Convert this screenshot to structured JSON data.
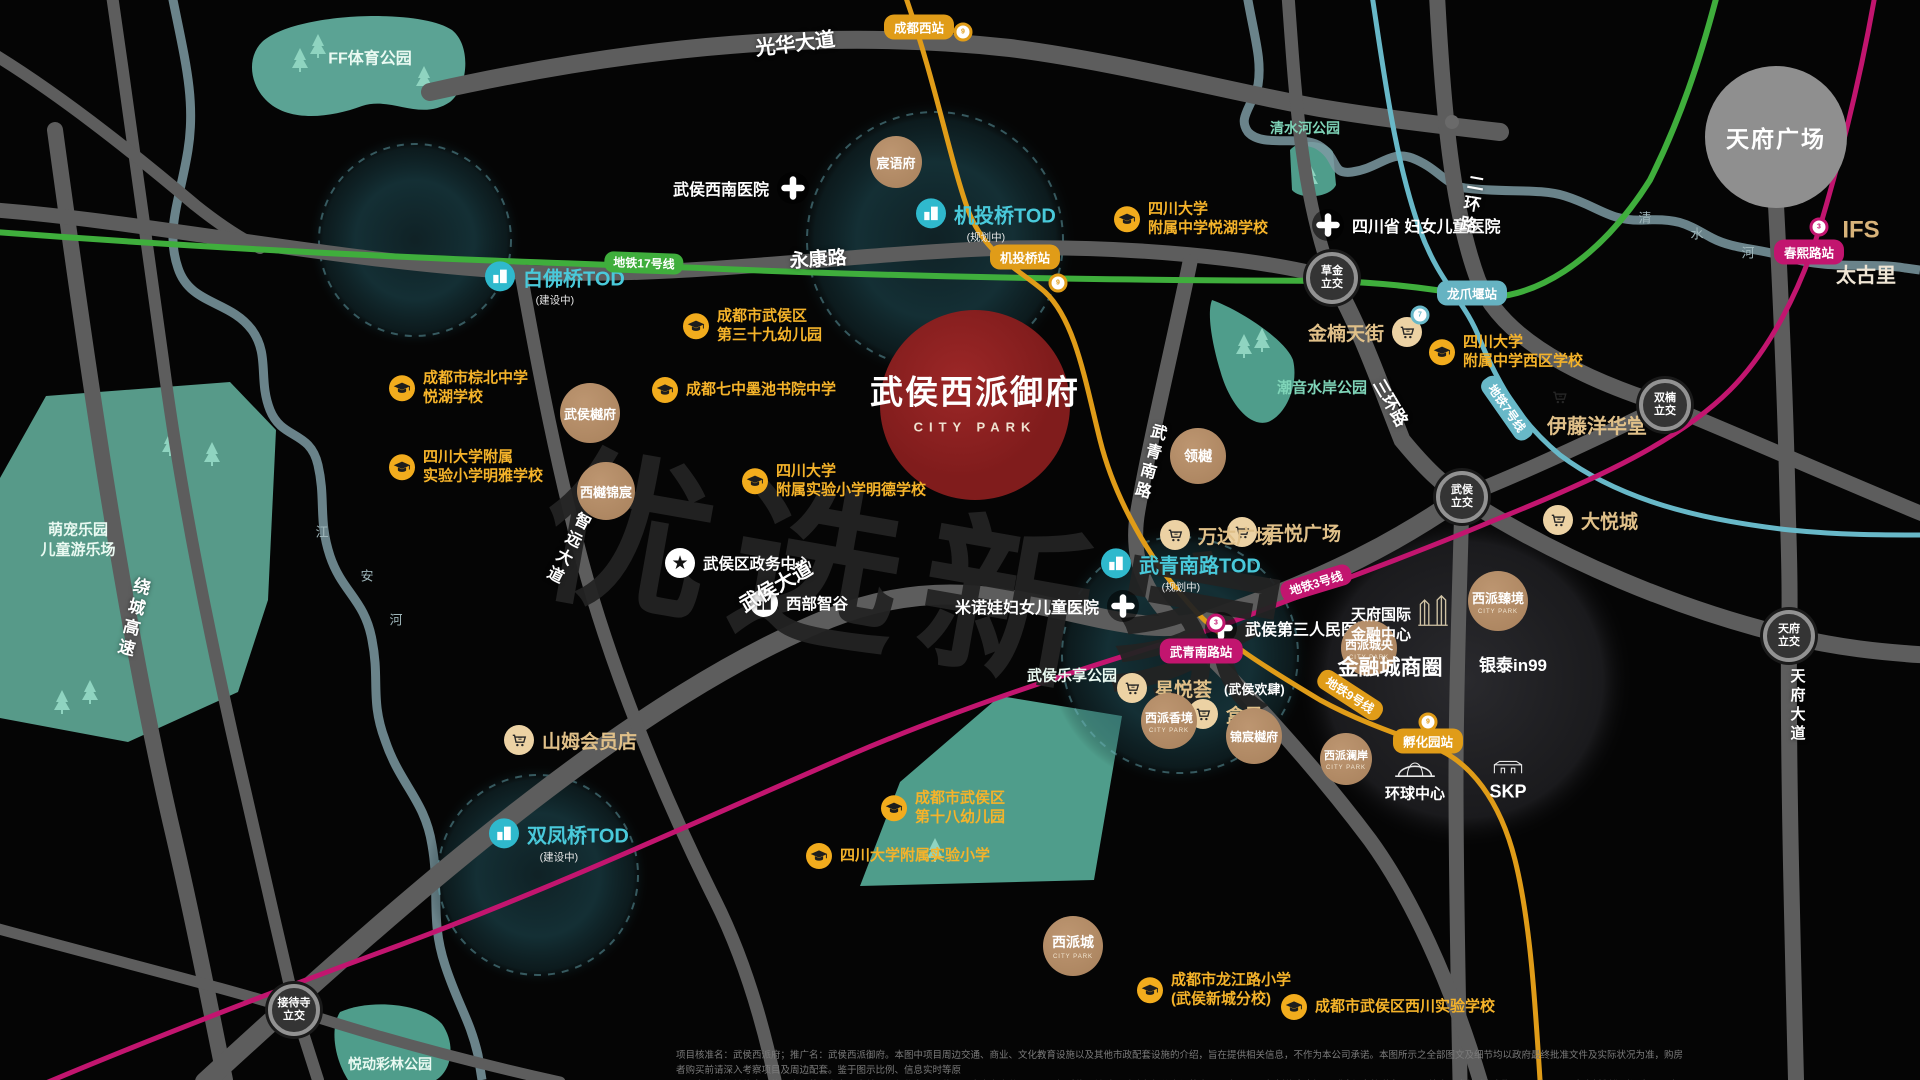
{
  "meta": {
    "title": "武侯西派御府 CITY PARK 区位图",
    "watermark": "优选新家"
  },
  "disclaimer": {
    "line1": "项目核准名：武侯西派府；推广名：武侯西派御府。本图中项目周边交通、商业、文化教育设施以及其他市政配套设施的介绍，旨在提供相关信息，不作为本公司承诺。本图所示之全部图文及细节均以政府最终批准文件及实际状况为准，购房者购买前请深入考察项目及周边配套。鉴于图示比例、信息实时等原",
    "line2": "因，本图中相关信息可能与实际状况存在一定差异，仅作为项目位置示意之参考使用，图示相对位置关系不反映各部分之间的实际距离；TOD规划信息来源于《成都市轨道交通TOD综合开发战略规划》，2021年3月。本资料制作时间为2025年10月，本公司保留对本资料进行修改的权利，敬请留意最新资料。"
  },
  "colors": {
    "metro17": "#3fae3c",
    "metro9": "#e09c18",
    "metro3": "#c2156f",
    "metro7": "#68b8c8",
    "school": "#f5b32a",
    "tod": "#49c9da",
    "shop_text": "#e0c089",
    "project_red": "#8e2222"
  },
  "pois": [
    {
      "type": "tod",
      "name": "tod-baifoqiao",
      "x": 500,
      "y": 288,
      "label": "白佛桥TOD",
      "sub": "(建设中)"
    },
    {
      "type": "tod",
      "name": "tod-jitouqiao",
      "x": 931,
      "y": 225,
      "label": "机投桥TOD",
      "sub": "(规划中)"
    },
    {
      "type": "tod",
      "name": "tod-wuqingnanlu",
      "x": 1116,
      "y": 575,
      "label": "武青南路TOD",
      "sub": "(规划中)"
    },
    {
      "type": "tod",
      "name": "tod-shuangfengqiao",
      "x": 504,
      "y": 845,
      "label": "双凤桥TOD",
      "sub": "(建设中)"
    },
    {
      "type": "projtitle",
      "name": "project-title",
      "x": 975,
      "y": 400,
      "label": "武侯西派御府",
      "sub": "CITY PARK"
    },
    {
      "type": "school",
      "name": "school-39-kindergarten",
      "x": 696,
      "y": 326,
      "lines": [
        "成都市武侯区",
        "第三十九幼儿园"
      ]
    },
    {
      "type": "school",
      "name": "school-yuehu-middle",
      "x": 1127,
      "y": 219,
      "lines": [
        "四川大学",
        "附属中学悦湖学校"
      ]
    },
    {
      "type": "school",
      "name": "school-mochi-academy",
      "x": 665,
      "y": 390,
      "lines": [
        "成都七中墨池书院中学"
      ]
    },
    {
      "type": "school",
      "name": "school-mingde-primary",
      "x": 755,
      "y": 481,
      "lines": [
        "四川大学",
        "附属实验小学明德学校"
      ]
    },
    {
      "type": "school",
      "name": "school-zongbei-middle",
      "x": 402,
      "y": 388,
      "lines": [
        "成都市棕北中学",
        "悦湖学校"
      ]
    },
    {
      "type": "school",
      "name": "school-mingya-primary",
      "x": 402,
      "y": 467,
      "lines": [
        "四川大学附属",
        "实验小学明雅学校"
      ]
    },
    {
      "type": "school",
      "name": "school-xiqu-middle",
      "x": 1442,
      "y": 352,
      "lines": [
        "四川大学",
        "附属中学西区学校"
      ]
    },
    {
      "type": "school",
      "name": "school-18-kindergarten",
      "x": 894,
      "y": 808,
      "lines": [
        "成都市武侯区",
        "第十八幼儿园"
      ]
    },
    {
      "type": "school",
      "name": "school-scu-primary",
      "x": 819,
      "y": 856,
      "lines": [
        "四川大学附属实验小学"
      ]
    },
    {
      "type": "school",
      "name": "school-longjiang-primary",
      "x": 1150,
      "y": 990,
      "lines": [
        "成都市龙江路小学",
        "(武侯新城分校)"
      ]
    },
    {
      "type": "school",
      "name": "school-xichuan-experimental",
      "x": 1294,
      "y": 1007,
      "lines": [
        "成都市武侯区西川实验学校"
      ]
    },
    {
      "type": "hospital",
      "name": "hospital-wuhou-southwest",
      "x": 793,
      "y": 188,
      "label": "武侯西南医院",
      "side": "r"
    },
    {
      "type": "hospital",
      "name": "hospital-sichuan-women-children",
      "x": 1328,
      "y": 225,
      "label": "四川省 妇女儿童医院",
      "side": "l"
    },
    {
      "type": "hospital",
      "name": "hospital-minuowa",
      "x": 1123,
      "y": 606,
      "label": "米诺娃妇女儿童医院",
      "side": "r"
    },
    {
      "type": "hospital",
      "name": "hospital-wuhou-third",
      "x": 1221,
      "y": 628,
      "label": "武侯第三人民医院",
      "side": "l"
    },
    {
      "type": "gov",
      "name": "gov-wuhou-admin-center",
      "x": 680,
      "y": 563,
      "label": "武侯区政务中心"
    },
    {
      "type": "biz",
      "name": "biz-west-smart-valley",
      "x": 764,
      "y": 603,
      "label": "西部智谷"
    },
    {
      "type": "shop",
      "name": "shop-jinnan-tianjie",
      "x": 1407,
      "y": 332,
      "label": "金楠天街",
      "side": "r"
    },
    {
      "type": "glyph",
      "name": "cart-icon-yito",
      "x": 1560,
      "y": 400,
      "glyph": "cart"
    },
    {
      "type": "landmark",
      "name": "shop-yito-yokado",
      "x": 1597,
      "y": 427,
      "label": "伊藤洋华堂",
      "fs": 20,
      "col": "#e0c089"
    },
    {
      "type": "shop",
      "name": "shop-joy-city",
      "x": 1558,
      "y": 520,
      "label": "大悦城",
      "side": "l"
    },
    {
      "type": "shop",
      "name": "shop-wuyue-plaza",
      "x": 1242,
      "y": 532,
      "label": "吾悦广场",
      "side": "l"
    },
    {
      "type": "shop",
      "name": "shop-wanda-plaza",
      "x": 1175,
      "y": 535,
      "label": "万达广场",
      "side": "l"
    },
    {
      "type": "shop",
      "name": "shop-xingyuehui",
      "x": 1132,
      "y": 688,
      "label": "星悦荟",
      "sub": "(武侯欢肆)",
      "side": "l"
    },
    {
      "type": "shop",
      "name": "shop-hema",
      "x": 1203,
      "y": 714,
      "label": "盒马",
      "side": "l"
    },
    {
      "type": "shop",
      "name": "shop-sams-club",
      "x": 519,
      "y": 740,
      "label": "山姆会员店",
      "side": "l"
    },
    {
      "type": "res",
      "name": "residence-chenyufu",
      "x": 896,
      "y": 162,
      "r": 26,
      "label": "宸语府",
      "fs": 13
    },
    {
      "type": "res",
      "name": "residence-wuhou-yuefu",
      "x": 590,
      "y": 413,
      "r": 30,
      "label": "武侯樾府",
      "fs": 13
    },
    {
      "type": "res",
      "name": "residence-xiyue-jinchen",
      "x": 606,
      "y": 491,
      "r": 29,
      "label": "西樾锦宸",
      "fs": 13
    },
    {
      "type": "res",
      "name": "residence-lingyue",
      "x": 1198,
      "y": 456,
      "r": 28,
      "label": "领樾",
      "fs": 14
    },
    {
      "type": "res",
      "name": "residence-xipai-zhenjing",
      "x": 1498,
      "y": 601,
      "r": 30,
      "label": "西派臻境",
      "fs": 13,
      "cp": "CITY PARK"
    },
    {
      "type": "res",
      "name": "residence-xipai-chengyang",
      "x": 1369,
      "y": 648,
      "r": 28,
      "label": "西派城央",
      "fs": 12,
      "cp": "CITY PARK"
    },
    {
      "type": "res",
      "name": "residence-xipai-xiangjing",
      "x": 1169,
      "y": 721,
      "r": 28,
      "label": "西派香境",
      "fs": 12,
      "cp": "CITY PARK"
    },
    {
      "type": "res",
      "name": "residence-jinchen-yuefu",
      "x": 1254,
      "y": 736,
      "r": 28,
      "label": "锦宸樾府",
      "fs": 12
    },
    {
      "type": "res",
      "name": "residence-xipai-cheng",
      "x": 1073,
      "y": 946,
      "r": 30,
      "label": "西派城",
      "fs": 14,
      "cp": "CITY PARK"
    },
    {
      "type": "res",
      "name": "residence-xipai-lanan",
      "x": 1346,
      "y": 759,
      "r": 26,
      "label": "西派澜岸",
      "fs": 11,
      "cp": "CITY PARK"
    },
    {
      "type": "itc",
      "name": "interchange-caojin",
      "x": 1332,
      "y": 278,
      "lines": [
        "草金",
        "立交"
      ]
    },
    {
      "type": "itc",
      "name": "interchange-shuangnan",
      "x": 1665,
      "y": 405,
      "lines": [
        "双楠",
        "立交"
      ]
    },
    {
      "type": "itc",
      "name": "interchange-wuhou",
      "x": 1462,
      "y": 497,
      "lines": [
        "武侯",
        "立交"
      ]
    },
    {
      "type": "itc",
      "name": "interchange-tianfu",
      "x": 1789,
      "y": 636,
      "lines": [
        "天府",
        "立交"
      ]
    },
    {
      "type": "itc",
      "name": "interchange-jiedaisi",
      "x": 294,
      "y": 1010,
      "lines": [
        "接待寺",
        "立交"
      ]
    },
    {
      "type": "plaza",
      "name": "landmark-tianfu-square",
      "x": 1776,
      "y": 137,
      "label": "天府广场"
    },
    {
      "type": "landmark",
      "name": "landmark-ifs",
      "x": 1861,
      "y": 230,
      "label": "IFS",
      "fs": 24,
      "col": "#d8b37a"
    },
    {
      "type": "landmark",
      "name": "landmark-taikoo-li",
      "x": 1866,
      "y": 276,
      "label": "太古里",
      "fs": 20,
      "col": "#efe5d4"
    },
    {
      "type": "landmark",
      "name": "landmark-tianfu-intl-finance",
      "x": 1381,
      "y": 625,
      "label": "天府国际\n金融中心",
      "fs": 15,
      "col": "#fff"
    },
    {
      "type": "glyph",
      "name": "twin-towers-icon",
      "x": 1433,
      "y": 612,
      "glyph": "towers"
    },
    {
      "type": "landmark",
      "name": "landmark-financial-city",
      "x": 1390,
      "y": 668,
      "label": "金融城商圈",
      "fs": 21,
      "col": "#fff"
    },
    {
      "type": "landmark",
      "name": "landmark-intime-in99",
      "x": 1513,
      "y": 666,
      "label": "银泰in99",
      "fs": 17,
      "col": "#fff"
    },
    {
      "type": "glyph",
      "name": "globe-center-icon",
      "x": 1415,
      "y": 771,
      "glyph": "globe"
    },
    {
      "type": "landmark",
      "name": "landmark-global-center",
      "x": 1415,
      "y": 794,
      "label": "环球中心",
      "fs": 15,
      "col": "#fff"
    },
    {
      "type": "glyph",
      "name": "skp-building-icon",
      "x": 1508,
      "y": 769,
      "glyph": "mall"
    },
    {
      "type": "landmark",
      "name": "landmark-skp",
      "x": 1508,
      "y": 792,
      "label": "SKP",
      "fs": 18,
      "col": "#fff"
    },
    {
      "type": "station",
      "name": "station-chengdu-west",
      "x": 919,
      "y": 27,
      "label": "成都西站",
      "line": "orange"
    },
    {
      "type": "station",
      "name": "station-jitouqiao",
      "x": 1025,
      "y": 257,
      "label": "机投桥站",
      "line": "orange"
    },
    {
      "type": "station",
      "name": "station-wuqingnanlu",
      "x": 1201,
      "y": 651,
      "label": "武青南路站",
      "line": "magenta"
    },
    {
      "type": "station",
      "name": "station-chunxilu",
      "x": 1809,
      "y": 252,
      "label": "春熙路站",
      "line": "magenta"
    },
    {
      "type": "station",
      "name": "station-longzhuayan",
      "x": 1472,
      "y": 293,
      "label": "龙爪堰站",
      "line": "teal"
    },
    {
      "type": "station",
      "name": "station-fuhuayuan",
      "x": 1428,
      "y": 741,
      "label": "孵化园站",
      "line": "orange"
    },
    {
      "type": "pill",
      "name": "metro-line-17-label",
      "x": 644,
      "y": 263,
      "label": "地铁17号线",
      "line": "green",
      "rot": 2
    },
    {
      "type": "pill",
      "name": "metro-line-3-label",
      "x": 1316,
      "y": 583,
      "label": "地铁3号线",
      "line": "magenta",
      "rot": -17
    },
    {
      "type": "pill",
      "name": "metro-line-7-label",
      "x": 1507,
      "y": 408,
      "label": "地铁7号线",
      "line": "teal",
      "rot": 55
    },
    {
      "type": "pill",
      "name": "metro-line-9-label",
      "x": 1350,
      "y": 695,
      "label": "地铁9号线",
      "line": "orange",
      "rot": 33
    },
    {
      "type": "roadlabel",
      "name": "road-label-guanghua",
      "x": 795,
      "y": 42,
      "label": "光华大道",
      "fs": 20,
      "rot": -7
    },
    {
      "type": "roadlabel",
      "name": "road-label-yongkang",
      "x": 818,
      "y": 258,
      "label": "永康路",
      "fs": 19,
      "rot": -4
    },
    {
      "type": "roadlabel",
      "name": "road-label-wuhou-dadao",
      "x": 775,
      "y": 585,
      "label": "武侯大道",
      "fs": 20,
      "rot": -30
    },
    {
      "type": "roadlabel",
      "name": "road-label-sanhuan",
      "x": 1392,
      "y": 402,
      "label": "三环路",
      "fs": 17,
      "rot": 60
    },
    {
      "type": "roadlabel",
      "name": "road-label-raocheng",
      "x": 132,
      "y": 618,
      "label": "绕城高速",
      "fs": 17,
      "vert": 1,
      "rot": 14
    },
    {
      "type": "roadlabel",
      "name": "road-label-zhiyuan",
      "x": 566,
      "y": 548,
      "label": "智远大道",
      "fs": 16,
      "vert": 1,
      "rot": 27
    },
    {
      "type": "roadlabel",
      "name": "road-label-wuqingnanlu",
      "x": 1148,
      "y": 462,
      "label": "武青南路",
      "fs": 16,
      "vert": 1,
      "rot": 15
    },
    {
      "type": "roadlabel",
      "name": "road-label-erhuan",
      "x": 1470,
      "y": 205,
      "label": "二环路",
      "fs": 17,
      "vert": 1,
      "rot": 10
    },
    {
      "type": "roadlabel",
      "name": "road-label-tianfu-dadao",
      "x": 1797,
      "y": 706,
      "label": "天府大道",
      "fs": 15,
      "vert": 1,
      "rot": 0
    },
    {
      "type": "parklabel",
      "name": "park-label-ff-sports",
      "x": 370,
      "y": 60,
      "label": "FF体育公园",
      "fs": 16,
      "col": "#eafaf2"
    },
    {
      "type": "parklabel",
      "name": "park-label-qingshuihe",
      "x": 1305,
      "y": 128,
      "label": "清水河公园",
      "fs": 14,
      "col": "#7fd4b8"
    },
    {
      "type": "parklabel",
      "name": "park-label-chaoyin",
      "x": 1322,
      "y": 388,
      "label": "潮音水岸公园",
      "fs": 15,
      "col": "#7fd4b8"
    },
    {
      "type": "parklabel",
      "name": "park-label-lexiang",
      "x": 1072,
      "y": 676,
      "label": "武侯乐享公园",
      "fs": 15,
      "col": "#eafaf2"
    },
    {
      "type": "parklabel",
      "name": "park-label-yuedong",
      "x": 390,
      "y": 1064,
      "label": "悦动彩林公园",
      "fs": 14,
      "col": "#eafaf2"
    },
    {
      "type": "parklabel",
      "name": "park-label-mengchong",
      "x": 78,
      "y": 540,
      "label": "萌宠乐园\n儿童游乐场",
      "fs": 15,
      "col": "#eafaf2"
    },
    {
      "type": "riverchar",
      "name": "river-label-qingshuihe",
      "x": 1645,
      "y": 217,
      "label": "清"
    },
    {
      "type": "riverchar",
      "name": "river-label-qingshuihe",
      "x": 1697,
      "y": 233,
      "label": "水"
    },
    {
      "type": "riverchar",
      "name": "river-label-qingshuihe",
      "x": 1748,
      "y": 252,
      "label": "河"
    },
    {
      "type": "riverchar",
      "name": "river-label-jiangan",
      "x": 322,
      "y": 531,
      "label": "江"
    },
    {
      "type": "riverchar",
      "name": "river-label-jiangan",
      "x": 367,
      "y": 575,
      "label": "安"
    },
    {
      "type": "riverchar",
      "name": "river-label-jiangan",
      "x": 396,
      "y": 619,
      "label": "河"
    },
    {
      "type": "marker",
      "name": "metro-station-dot",
      "x": 963,
      "y": 32,
      "label": "9",
      "col": "#e09c18"
    },
    {
      "type": "marker",
      "name": "metro-station-dot",
      "x": 1058,
      "y": 283,
      "label": "9",
      "col": "#e09c18"
    },
    {
      "type": "marker",
      "name": "metro-station-dot",
      "x": 1428,
      "y": 722,
      "label": "9",
      "col": "#e09c18"
    },
    {
      "type": "marker",
      "name": "metro-station-dot",
      "x": 1216,
      "y": 623,
      "label": "3",
      "col": "#c2156f"
    },
    {
      "type": "marker",
      "name": "metro-station-dot",
      "x": 1819,
      "y": 227,
      "label": "3",
      "col": "#c2156f"
    },
    {
      "type": "marker",
      "name": "metro-station-dot",
      "x": 1420,
      "y": 315,
      "label": "7",
      "col": "#68b8c8"
    }
  ]
}
